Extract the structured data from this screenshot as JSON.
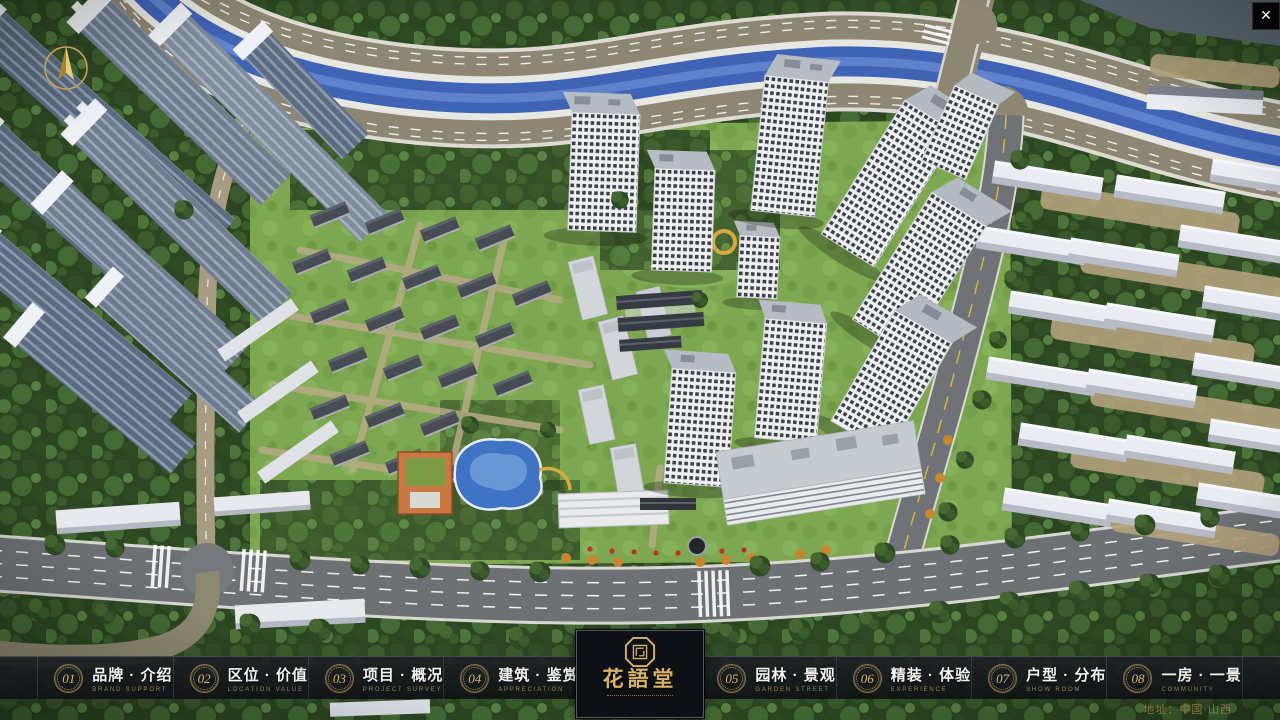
{
  "menu": {
    "items": [
      {
        "num": "01",
        "zh": "品牌 · 介绍",
        "en": "BRAND SUPPORT"
      },
      {
        "num": "02",
        "zh": "区位 · 价值",
        "en": "LOCATION VALUE"
      },
      {
        "num": "03",
        "zh": "项目 · 概况",
        "en": "PROJECT SURVEY"
      },
      {
        "num": "04",
        "zh": "建筑 · 鉴赏",
        "en": "APPRECIATION"
      },
      {
        "num": "05",
        "zh": "园林 · 景观",
        "en": "GARDEN STREET"
      },
      {
        "num": "06",
        "zh": "精装 · 体验",
        "en": "EXPERIENCE"
      },
      {
        "num": "07",
        "zh": "户型 · 分布",
        "en": "SHOW ROOM"
      },
      {
        "num": "08",
        "zh": "一房 · 一景",
        "en": "COMMUNITY"
      }
    ]
  },
  "logo": {
    "name_zh": "花語堂"
  },
  "footer": {
    "address": "地址：中国·山西"
  },
  "window": {
    "close_glyph": "✕"
  },
  "colors": {
    "gold": "#d9b36b",
    "bar_bg": "#14181c",
    "river": "#3f63b5",
    "lawn": "#7da851"
  }
}
